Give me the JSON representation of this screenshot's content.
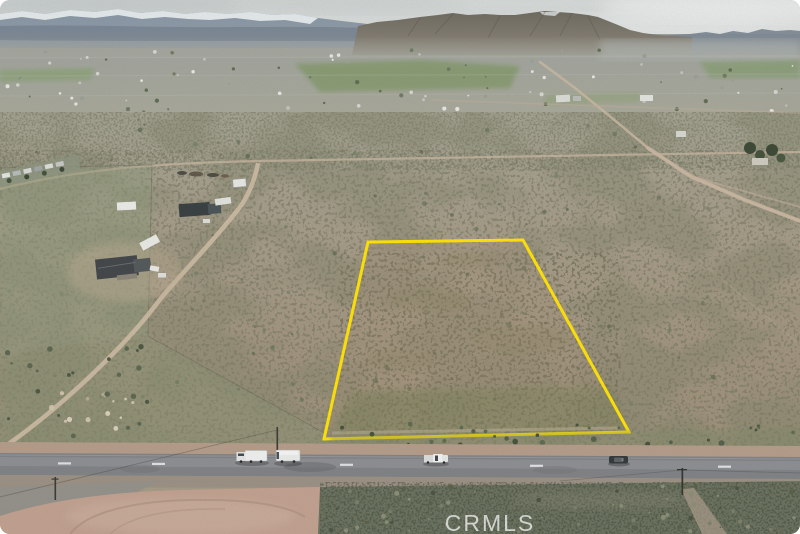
{
  "watermark": {
    "text": "CRMLS",
    "color": "rgba(255,255,255,0.72)"
  },
  "parcel": {
    "boundary_points": "368,242 523,240 629,432 324,439",
    "boundary_color": "#ffe205",
    "boundary_width": "3"
  },
  "palette": {
    "sky": "#d7dad9",
    "snow": "#e8edee",
    "mountain_rock": "#6f6a60",
    "distant_ridge": "#7e8a96",
    "valley": "#a4a69d",
    "field_green": "#7e9663",
    "desert": "#a49a86",
    "dirt_road": "#cdbba4",
    "asphalt": "#808285",
    "lane_marking": "#e9eaeb",
    "shoulder_dirt": "#b49c89",
    "pink_dirt_lot": "#c1a190",
    "bottom_scrub": "#6c7260",
    "white_vehicle": "#eef0ef",
    "dark_vehicle": "#35393c"
  }
}
